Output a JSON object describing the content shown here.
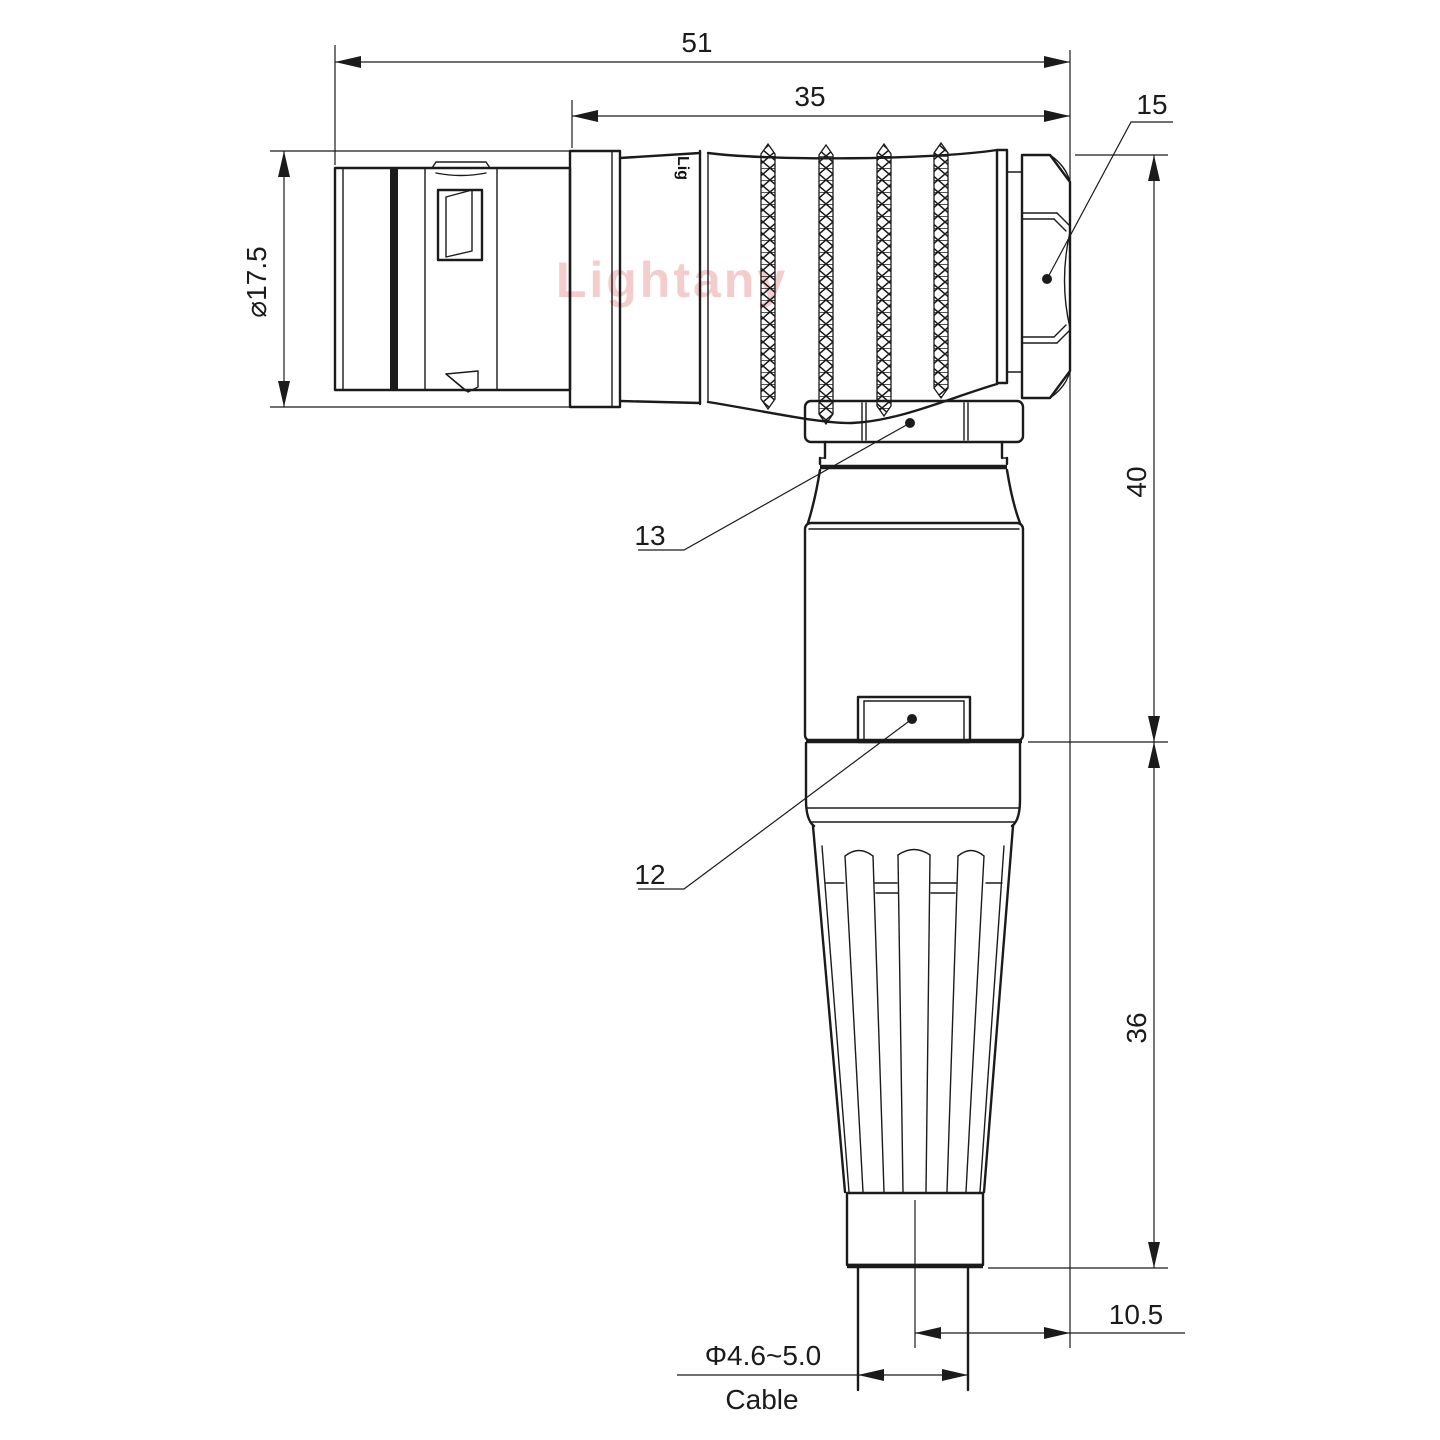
{
  "drawing": {
    "watermark": "Lightany",
    "part_marking": "Lig",
    "dimensions": {
      "overall_length": "51",
      "body_length": "35",
      "hex_ref": "15",
      "front_diameter": "⌀17.5",
      "upper_height": "40",
      "lower_height": "36",
      "cable_offset": "10.5",
      "cable_diameter": "Φ4.6~5.0",
      "cable_label": "Cable",
      "ref_13": "13",
      "ref_12": "12"
    },
    "colors": {
      "line": "#1b1b1b",
      "watermark": "#f1bcbc",
      "background": "#ffffff"
    }
  }
}
